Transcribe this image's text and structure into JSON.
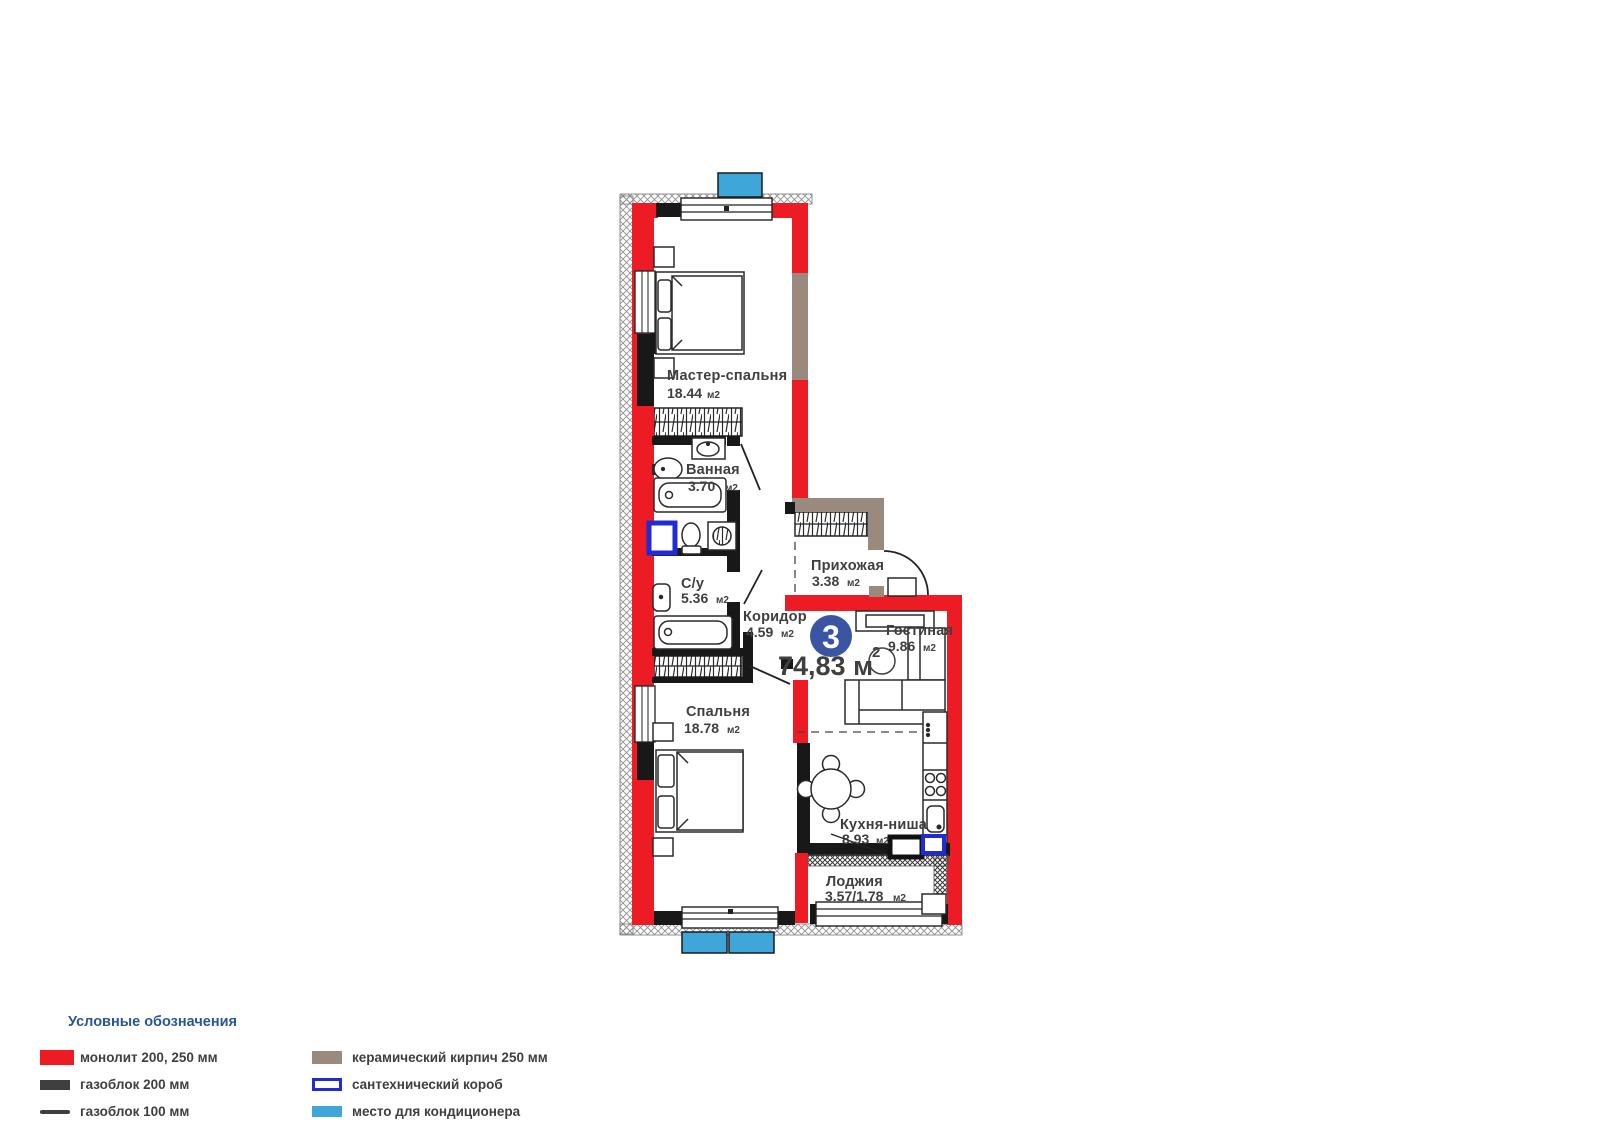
{
  "plan": {
    "unit_number": "3",
    "total_area_label": "74,83 м",
    "total_area_superscript": "2",
    "rooms": [
      {
        "name": "Мастер-спальня",
        "area": "18.44",
        "unit": "м2"
      },
      {
        "name": "Ванная",
        "area": "3.70",
        "unit": "м2"
      },
      {
        "name": "С/у",
        "area": "5.36",
        "unit": "м2"
      },
      {
        "name": "Коридор",
        "area": "4.59",
        "unit": "м2"
      },
      {
        "name": "Прихожая",
        "area": "3.38",
        "unit": "м2"
      },
      {
        "name": "Гостиная",
        "area": "9.86",
        "unit": "м2"
      },
      {
        "name": "Спальня",
        "area": "18.78",
        "unit": "м2"
      },
      {
        "name": "Кухня-ниша",
        "area": "8.93",
        "unit": "м2"
      },
      {
        "name": "Лоджия",
        "area": "3.57/1.78",
        "unit": "м2"
      }
    ]
  },
  "legend": {
    "title": "Условные обозначения",
    "items": [
      {
        "id": "monolith",
        "label": "монолит 200, 250 мм",
        "color": "#ed1c24"
      },
      {
        "id": "gasblock-200",
        "label": "газоблок 200 мм",
        "color": "#3f3f3f"
      },
      {
        "id": "gasblock-100",
        "label": "газоблок 100 мм",
        "color": "#3f3f3f"
      },
      {
        "id": "ceramic-brick",
        "label": "керамический кирпич 250 мм",
        "color": "#9a8a7d"
      },
      {
        "id": "plumbing-box",
        "label": "сантехнический короб",
        "color": "#1f2bd4"
      },
      {
        "id": "ac-place",
        "label": "место для кондиционера",
        "color": "#3fa6d9"
      }
    ]
  },
  "colors": {
    "monolith": "#ed1c24",
    "gasblock": "#181818",
    "ceramic": "#9a8a7d",
    "plumbing_box": "#1f2bd4",
    "ac": "#3fa6d9",
    "unit_circle": "#3a55a4",
    "text": "#3f3f3f",
    "legend_title": "#2b5694"
  }
}
